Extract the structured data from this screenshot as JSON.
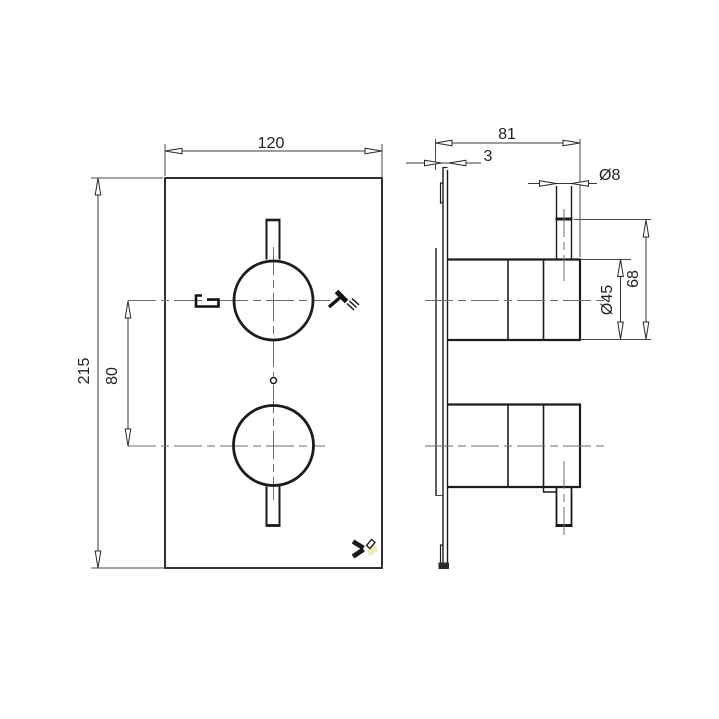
{
  "drawing": {
    "title": "Thermostatic shower valve dimension drawing",
    "front": {
      "width": "120",
      "height": "215",
      "handle_offset": "80"
    },
    "side": {
      "depth": "81",
      "plate_thickness": "3",
      "stem_diameter": "Ø8",
      "handle_height": "68",
      "trim_diameter": "Ø45"
    },
    "icons": {
      "bath": "bath-spout-icon",
      "shower": "shower-head-icon",
      "logo": "brand-logo"
    },
    "colors": {
      "object_line": "#1c1c1c",
      "dimension_line": "#3a3a3a",
      "centerline": "#6e6e6e",
      "logo_accent": "#f1ecc3",
      "background": "#ffffff"
    }
  }
}
